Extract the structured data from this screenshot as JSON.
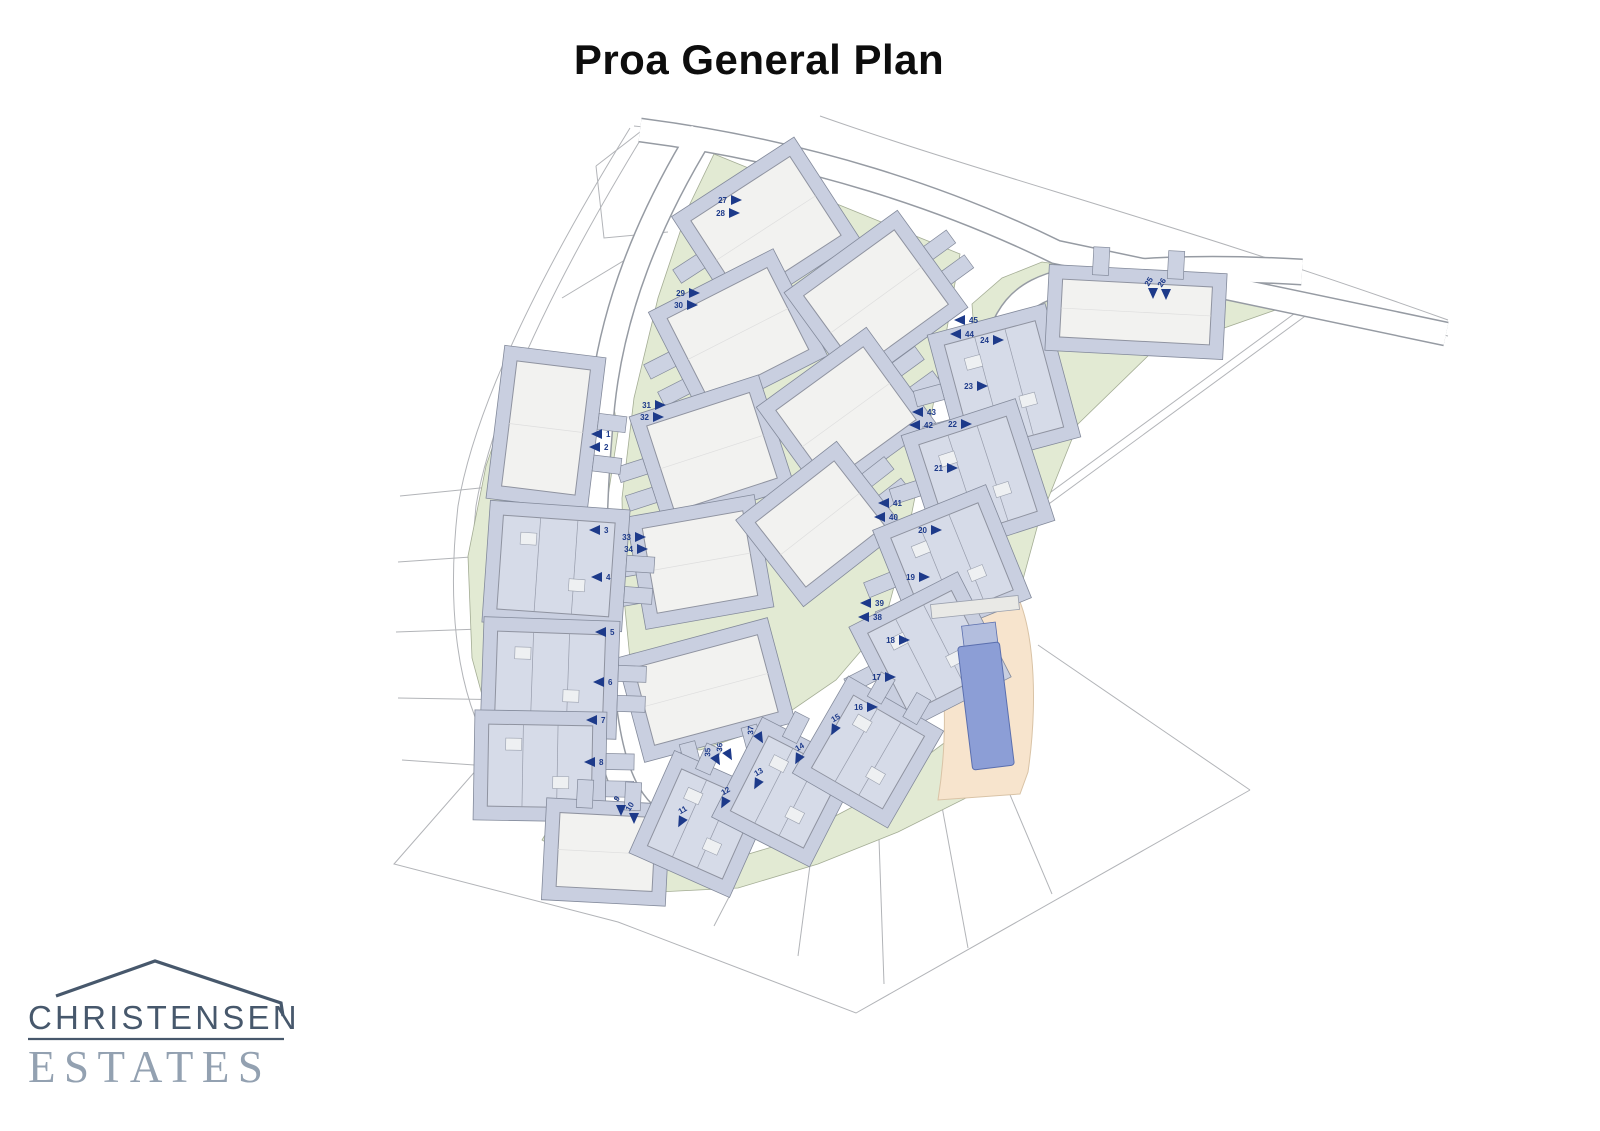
{
  "title": "Proa General Plan",
  "logo": {
    "line1": "CHRISTENSEN",
    "line2": "ESTATES"
  },
  "colors": {
    "arrow": "#1d3a8a",
    "green": "#e2ead3",
    "green_stroke": "#a4ad95",
    "terrace": "#c9cfe0",
    "terrace_stroke": "#838a9b",
    "roof_white": "#f2f2f0",
    "roof_gray": "#d6dbe8",
    "roof_stroke": "#8f93a0",
    "accessory": "#ccd2e2",
    "road_casing": "#969ba3",
    "road_fill": "#ffffff",
    "boundary": "#b2b4b8",
    "pool_deck": "#f7e4cd",
    "pool_deck_stroke": "#d9c3a6",
    "pool_water": "#8c9ed6",
    "pool_water_stroke": "#5b6fae",
    "logo_dark": "#47586c",
    "logo_light": "#93a1b1"
  },
  "map": {
    "boundaries": [
      "M630,128 C556,248 476,396 458,506 C446,610 458,696 492,752",
      "M644,134 C572,252 494,398 476,506 C466,604 478,686 508,740",
      "M492,752 L394,864 L618,922 L856,1013 L1250,790",
      "M1250,790 L1038,645",
      "M634,126 C800,142 950,194 1056,250 L1448,336",
      "M820,116 C990,176 1180,224 1448,320",
      "M400,496 L520,484",
      "M398,562 L514,554",
      "M396,632 L510,628",
      "M398,698 L514,700",
      "M402,760 L518,768",
      "M636,900 L668,860",
      "M714,926 L744,868",
      "M798,956 L812,850",
      "M884,984 L878,810",
      "M968,948 L936,774",
      "M1052,894 L986,738",
      "M562,298 L658,240",
      "M596,166 L604,238 L668,232",
      "M640,132 L596,166",
      "M1010,522 L1302,308",
      "M1016,528 L1308,314"
    ],
    "greens": [
      "518,372 606,358 618,432 604,522 598,612 592,702 596,770 564,806 498,754 472,658 468,556 486,466",
      "714,154 960,254 950,312 930,422 906,542 884,624 836,680 766,728 700,750 660,744 634,700 624,598 622,498 634,398 658,298 688,208",
      "972,304 1002,278 1042,262 1304,300 1150,354 1078,424 1038,524 1006,642 998,706 938,692 918,642 940,560 962,468 978,388",
      "560,810 640,850 702,868 782,844 862,802 932,752 994,706 1000,748 978,792 898,832 818,864 738,888 658,892 598,872 542,840"
    ],
    "roads": [
      {
        "d": "M702,132 C648,220 612,310 602,405 C592,505 590,620 604,708 C612,772 630,816 668,828 C706,840 764,812 832,764 C892,720 928,666 947,598 C966,532 976,442 991,372 C1003,312 1020,292 1068,281 C1120,270 1200,266 1302,272",
        "w": 24
      },
      {
        "d": "M640,130 C810,152 950,200 1056,252 L1446,334",
        "w": 22
      }
    ],
    "buildings": [
      {
        "x": 766,
        "y": 228,
        "w": 118,
        "h": 94,
        "r": -33,
        "t": "A",
        "a": "w"
      },
      {
        "x": 738,
        "y": 334,
        "w": 112,
        "h": 92,
        "r": -27,
        "t": "A",
        "a": "w"
      },
      {
        "x": 712,
        "y": 452,
        "w": 108,
        "h": 90,
        "r": -18,
        "t": "A",
        "a": "w"
      },
      {
        "x": 700,
        "y": 562,
        "w": 102,
        "h": 86,
        "r": -10,
        "t": "A",
        "a": "w"
      },
      {
        "x": 876,
        "y": 300,
        "w": 112,
        "h": 92,
        "r": -36,
        "t": "A",
        "a": "e"
      },
      {
        "x": 846,
        "y": 415,
        "w": 108,
        "h": 90,
        "r": -36,
        "t": "A",
        "a": "e"
      },
      {
        "x": 820,
        "y": 524,
        "w": 100,
        "h": 82,
        "r": -38,
        "t": "A",
        "a": "e"
      },
      {
        "x": 706,
        "y": 690,
        "w": 128,
        "h": 80,
        "r": -15,
        "t": "A",
        "a": "s"
      },
      {
        "x": 546,
        "y": 428,
        "w": 74,
        "h": 126,
        "r": 7,
        "t": "A",
        "a": "e"
      },
      {
        "x": 556,
        "y": 566,
        "w": 112,
        "h": 94,
        "r": 4,
        "t": "B",
        "a": "e"
      },
      {
        "x": 550,
        "y": 678,
        "w": 108,
        "h": 90,
        "r": 2,
        "t": "B",
        "a": "e"
      },
      {
        "x": 540,
        "y": 766,
        "w": 104,
        "h": 82,
        "r": 1,
        "t": "B",
        "a": "e"
      },
      {
        "x": 1004,
        "y": 386,
        "w": 94,
        "h": 110,
        "r": -15,
        "t": "B",
        "a": "w"
      },
      {
        "x": 978,
        "y": 478,
        "w": 92,
        "h": 100,
        "r": -18,
        "t": "B",
        "a": "w"
      },
      {
        "x": 952,
        "y": 564,
        "w": 94,
        "h": 94,
        "r": -22,
        "t": "B",
        "a": "w"
      },
      {
        "x": 930,
        "y": 652,
        "w": 94,
        "h": 90,
        "r": -27,
        "t": "B",
        "a": "w"
      },
      {
        "x": 1136,
        "y": 312,
        "w": 150,
        "h": 58,
        "r": 3,
        "t": "A",
        "a": "n"
      },
      {
        "x": 606,
        "y": 852,
        "w": 96,
        "h": 74,
        "r": 3,
        "t": "A",
        "a": "n"
      },
      {
        "x": 702,
        "y": 824,
        "w": 82,
        "h": 84,
        "r": 24,
        "t": "B",
        "a": "n"
      },
      {
        "x": 786,
        "y": 792,
        "w": 82,
        "h": 84,
        "r": 27,
        "t": "B",
        "a": "n"
      },
      {
        "x": 868,
        "y": 752,
        "w": 82,
        "h": 84,
        "r": 30,
        "t": "B",
        "a": "n"
      }
    ],
    "pool": {
      "deck": "M930,594 L1008,582 C1032,606 1040,690 1028,772 L1020,794 L938,800 C950,726 944,658 930,594 Z",
      "bar": {
        "x": 975,
        "y": 607,
        "w": 88,
        "h": 14,
        "r": -6
      },
      "water": {
        "x": 986,
        "y": 706,
        "w": 42,
        "h": 124,
        "r": -7
      },
      "hatch": {
        "x": 980,
        "y": 637,
        "w": 34,
        "h": 26,
        "r": -7
      }
    },
    "arrows": [
      {
        "n": "1",
        "x": 597,
        "y": 434,
        "d": "l"
      },
      {
        "n": "2",
        "x": 595,
        "y": 447,
        "d": "l"
      },
      {
        "n": "3",
        "x": 595,
        "y": 530,
        "d": "l"
      },
      {
        "n": "4",
        "x": 597,
        "y": 577,
        "d": "l"
      },
      {
        "n": "5",
        "x": 601,
        "y": 632,
        "d": "l"
      },
      {
        "n": "6",
        "x": 599,
        "y": 682,
        "d": "l"
      },
      {
        "n": "7",
        "x": 592,
        "y": 720,
        "d": "l"
      },
      {
        "n": "8",
        "x": 590,
        "y": 762,
        "d": "l"
      },
      {
        "n": "9",
        "x": 621,
        "y": 810,
        "d": "d"
      },
      {
        "n": "10",
        "x": 634,
        "y": 818,
        "d": "d"
      },
      {
        "n": "11",
        "x": 681,
        "y": 822,
        "d": "dr"
      },
      {
        "n": "12",
        "x": 724,
        "y": 803,
        "d": "dr"
      },
      {
        "n": "13",
        "x": 757,
        "y": 784,
        "d": "dr"
      },
      {
        "n": "14",
        "x": 798,
        "y": 759,
        "d": "dr"
      },
      {
        "n": "15",
        "x": 834,
        "y": 730,
        "d": "dr"
      },
      {
        "n": "16",
        "x": 872,
        "y": 707,
        "d": "r"
      },
      {
        "n": "17",
        "x": 890,
        "y": 677,
        "d": "r"
      },
      {
        "n": "18",
        "x": 904,
        "y": 640,
        "d": "r"
      },
      {
        "n": "19",
        "x": 924,
        "y": 577,
        "d": "r"
      },
      {
        "n": "20",
        "x": 936,
        "y": 530,
        "d": "r"
      },
      {
        "n": "21",
        "x": 952,
        "y": 468,
        "d": "r"
      },
      {
        "n": "22",
        "x": 966,
        "y": 424,
        "d": "r"
      },
      {
        "n": "23",
        "x": 982,
        "y": 386,
        "d": "r"
      },
      {
        "n": "24",
        "x": 998,
        "y": 340,
        "d": "r"
      },
      {
        "n": "25",
        "x": 1153,
        "y": 293,
        "d": "d"
      },
      {
        "n": "26",
        "x": 1166,
        "y": 294,
        "d": "d"
      },
      {
        "n": "27",
        "x": 736,
        "y": 200,
        "d": "r"
      },
      {
        "n": "28",
        "x": 734,
        "y": 213,
        "d": "r"
      },
      {
        "n": "29",
        "x": 694,
        "y": 293,
        "d": "r"
      },
      {
        "n": "30",
        "x": 692,
        "y": 305,
        "d": "r"
      },
      {
        "n": "31",
        "x": 660,
        "y": 405,
        "d": "r"
      },
      {
        "n": "32",
        "x": 658,
        "y": 417,
        "d": "r"
      },
      {
        "n": "33",
        "x": 640,
        "y": 537,
        "d": "r"
      },
      {
        "n": "34",
        "x": 642,
        "y": 549,
        "d": "r"
      },
      {
        "n": "35",
        "x": 717,
        "y": 760,
        "d": "dl"
      },
      {
        "n": "36",
        "x": 729,
        "y": 755,
        "d": "dl"
      },
      {
        "n": "37",
        "x": 760,
        "y": 738,
        "d": "dl"
      },
      {
        "n": "38",
        "x": 864,
        "y": 617,
        "d": "l"
      },
      {
        "n": "39",
        "x": 866,
        "y": 603,
        "d": "l"
      },
      {
        "n": "40",
        "x": 880,
        "y": 517,
        "d": "l"
      },
      {
        "n": "41",
        "x": 884,
        "y": 503,
        "d": "l"
      },
      {
        "n": "42",
        "x": 915,
        "y": 425,
        "d": "l"
      },
      {
        "n": "43",
        "x": 918,
        "y": 412,
        "d": "l"
      },
      {
        "n": "44",
        "x": 956,
        "y": 334,
        "d": "l"
      },
      {
        "n": "45",
        "x": 960,
        "y": 320,
        "d": "l"
      }
    ]
  }
}
